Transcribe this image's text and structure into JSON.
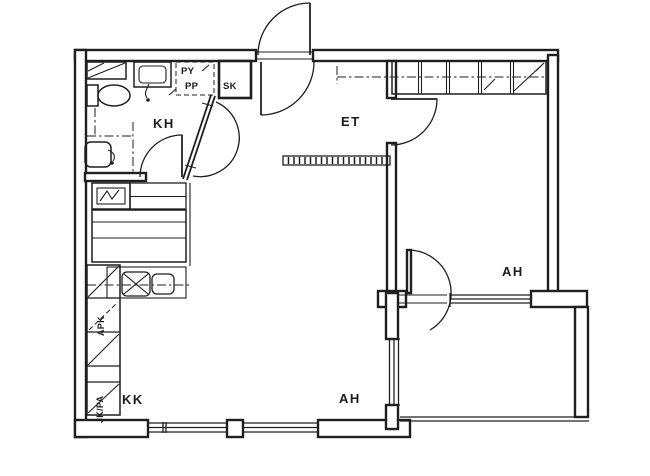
{
  "plan": {
    "kind": "apartment-floor-plan",
    "colors": {
      "line": "#1f1f1f",
      "background": "#ffffff"
    },
    "rooms": {
      "bathroom": "KH",
      "hallway": "ET",
      "bedroom": "AH",
      "living_room": "AH",
      "kitchenette": "KK"
    },
    "closets": {
      "cleaning_closet": "SK"
    },
    "appliances": {
      "laundry_reserve_upper": "PY",
      "laundry_reserve_lower": "PP",
      "dishwasher": "APK",
      "fridge_freezer": "JK/PA"
    }
  }
}
